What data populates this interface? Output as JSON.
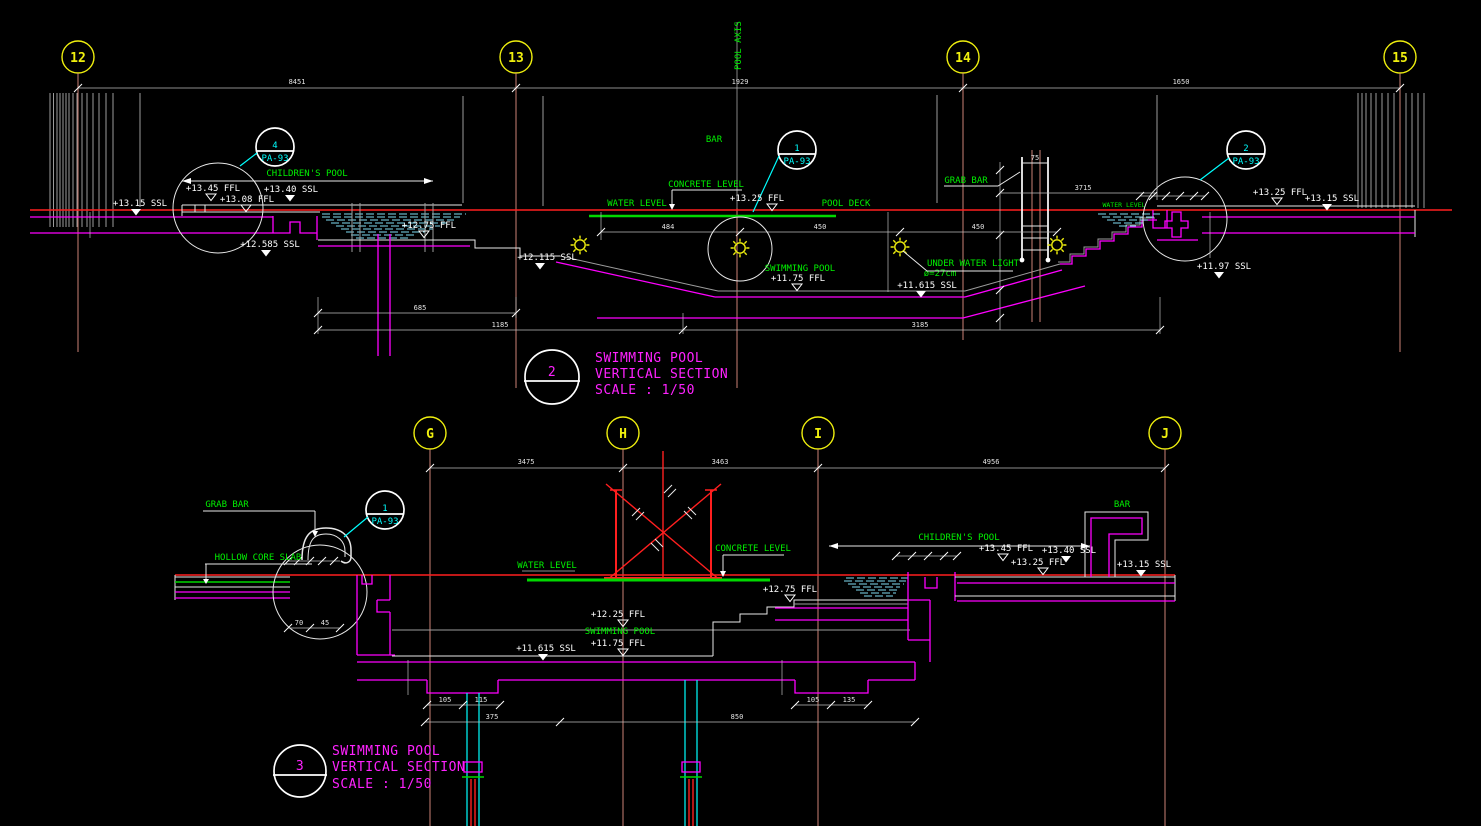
{
  "colors": {
    "background": "#000000",
    "grid_bubble": "#f0f00e",
    "annotation_green": "#00f000",
    "structure_magenta": "#ff00ff",
    "callout_cyan": "#00ffff",
    "water_hatch": "#7fdcf2",
    "datum_red": "#ff1f1f",
    "text_white": "#ffffff",
    "grid_line": "#cd8276"
  },
  "top": {
    "grids": [
      "12",
      "13",
      "14",
      "15"
    ],
    "grid_dims": [
      "8451",
      "1929",
      "1650"
    ],
    "pool_axis": "POOL AXIS",
    "labels": {
      "children": "CHILDREN'S POOL",
      "bar": "BAR",
      "concrete": "CONCRETE LEVEL",
      "water": "WATER LEVEL",
      "deck": "POOL DECK",
      "grab": "GRAB BAR",
      "swim": "SWIMMING POOL",
      "uwl": "UNDER WATER LIGHT",
      "uwl_dia": "ø=27cm",
      "water_small": "WATER LEVEL"
    },
    "elev": {
      "ssl_left": "+13.15 SSL",
      "ffl_1345": "+13.45 FFL",
      "ffl_1308": "+13.08 FFL",
      "ssl_1340": "+13.40 SSL",
      "ffl_1275": "+12.75 FFL",
      "ssl_12585": "+12.585 SSL",
      "ssl_12115": "+12.115 SSL",
      "ffl_1325": "+13.25 FFL",
      "ffl_1175": "+11.75 FFL",
      "ssl_11615": "+11.615 SSL",
      "ssl_1197": "+11.97 SSL",
      "ffl_1325_r": "+13.25 FFL",
      "ssl_1315_r": "+13.15 SSL"
    },
    "dims": {
      "a": "484",
      "b": "450",
      "c": "450",
      "run": "3715",
      "lad": "75",
      "d685": "685",
      "d1185": "1185",
      "d3185": "3185"
    },
    "callouts": {
      "c4": {
        "num": "4",
        "sheet": "PA-93"
      },
      "c1": {
        "num": "1",
        "sheet": "PA-93"
      },
      "c2": {
        "num": "2",
        "sheet": "PA-93"
      }
    },
    "title": {
      "num": "2",
      "l1": "SWIMMING POOL",
      "l2": "VERTICAL SECTION",
      "l3": "SCALE : 1/50"
    }
  },
  "bottom": {
    "grids": [
      "G",
      "H",
      "I",
      "J"
    ],
    "grid_dims": [
      "3475",
      "3463",
      "4956"
    ],
    "labels": {
      "grab": "GRAB BAR",
      "hollow": "HOLLOW CORE SLAB",
      "water": "WATER LEVEL",
      "concrete": "CONCRETE LEVEL",
      "swim": "SWIMMING POOL",
      "children": "CHILDREN'S POOL",
      "bar": "BAR"
    },
    "elev": {
      "ffl_1225": "+12.25 FFL",
      "ffl_1175": "+11.75 FFL",
      "ssl_11615": "+11.615 SSL",
      "ffl_1275": "+12.75 FFL",
      "ffl_1345": "+13.45 FFL",
      "ssl_1340": "+13.40 SSL",
      "ffl_1325": "+13.25 FFL",
      "ssl_1315": "+13.15 SSL"
    },
    "dims": {
      "a": "105",
      "b": "115",
      "c": "105",
      "d": "135",
      "e": "375",
      "f": "850",
      "g": "70",
      "h": "45"
    },
    "callout": {
      "num": "1",
      "sheet": "PA-93"
    },
    "title": {
      "num": "3",
      "l1": "SWIMMING POOL",
      "l2": "VERTICAL SECTION",
      "l3": "SCALE : 1/50"
    }
  }
}
